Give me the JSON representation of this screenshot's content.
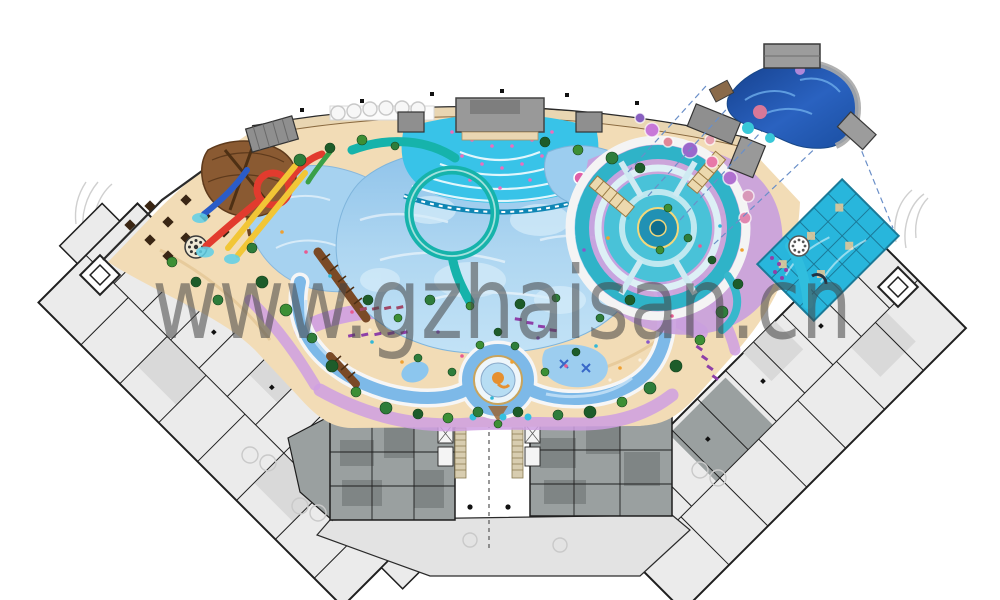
{
  "title": "Water park resort master plan rendering",
  "watermark": {
    "text": "www.gzhaisan.cn",
    "color": "#454545",
    "opacity": "0.55"
  },
  "palette": {
    "sand": "#f2dcb6",
    "pool_blue": "#a6d2f0",
    "wave_cyan": "#38c3e8",
    "river_blue": "#7db9e8",
    "path_purple": "#cf9fe2",
    "deck_lavender": "#c9a0dd",
    "slide_red": "#e23b2e",
    "slide_yellow": "#f2c636",
    "slide_teal": "#16b3ab",
    "slide_blue": "#2b5cc8",
    "bowl_teal": "#2fb3c8",
    "inset_navy": "#1d4fa0",
    "building_light_gray": "#ebebeb",
    "building_mid_gray": "#9aa0a0",
    "roof_gray": "#8f8f8f",
    "wall_black": "#1f1f1f",
    "tree_green": "#2e7d3b",
    "wood_brown": "#8a5a32",
    "spa_cyan": "#28b6dc"
  },
  "features": [
    "wave-pool",
    "surf-arc-zone",
    "lazy-river",
    "tornado-bowl-ride",
    "spiral-slide",
    "loop-slide",
    "racing-slides",
    "kids-splash-pool",
    "wooden-play-structure",
    "spa-pool",
    "central-fountain",
    "detail-inset-callout",
    "hotel-wing-left",
    "hotel-wing-right",
    "changing-room-blocks",
    "dining-terrace",
    "carousel-left",
    "carousel-right"
  ]
}
